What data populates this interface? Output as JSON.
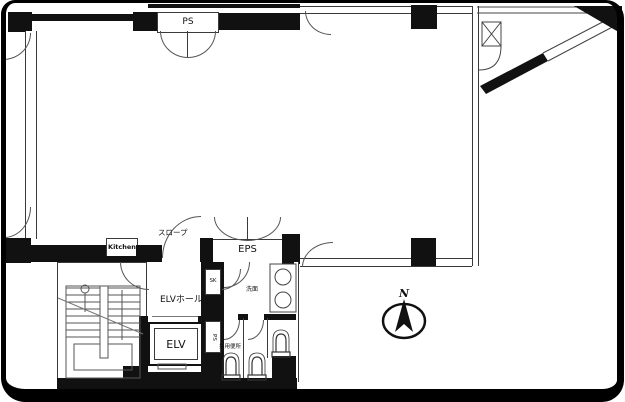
{
  "plan": {
    "labels": {
      "ps_shaft": "PS",
      "slope": "スロープ",
      "kitchen": "Kitchen",
      "eps": "EPS",
      "elevator_hall": "ELVホール",
      "elevator": "ELV",
      "pipe_space": "PS",
      "sink_closet": "SK",
      "washroom": "洗面",
      "shared_toilet": "共用便所",
      "north": "N"
    },
    "colors": {
      "wall": "#111111",
      "line": "#3a3a3a",
      "background": "#ffffff"
    }
  }
}
